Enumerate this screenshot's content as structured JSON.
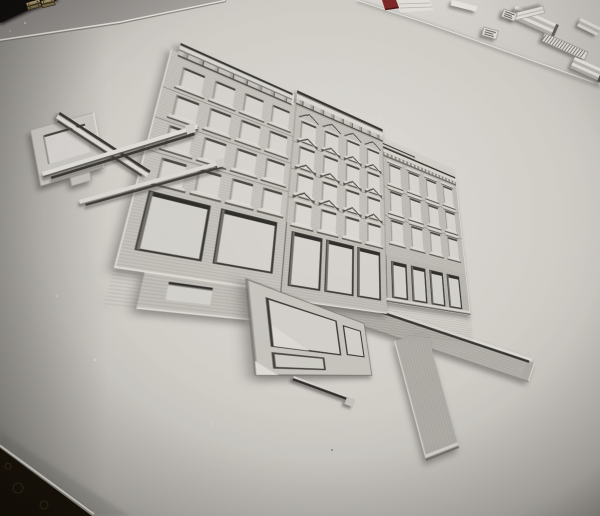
{
  "scene": {
    "description": "Overhead photograph of a hand-built architectural paper model: three row-building facades with cut-out windows, cornices and storefronts, lying flat on a large sheet of textured white watercolor paper",
    "surface": "white textured watercolor paper",
    "surroundings": {
      "top_left": "dark tabletop corner with two small brass hinge clasps",
      "top_right": "second paper sheet holding small spare model parts",
      "top_edge": "small dark-red object and white paper wedge",
      "bottom_left": "dark patterned fabric visible past the paper edge"
    }
  },
  "palette": {
    "paper_light": "#e0ddd8",
    "paper_mid": "#d2cfc9",
    "paper_dark": "#a19e99",
    "table_gray": "#9b9894",
    "second_sheet": "#d9d6d1",
    "wall_a": "#c9c6c0",
    "wall_b": "#c6c3bd",
    "wall_c": "#c2bfb9",
    "storefront_a": "#c6c3bd",
    "storefront_b": "#c2bfb9",
    "storefront_c": "#bebbb5",
    "opening": "#d8d5d0",
    "shadow_line": "#47443f",
    "deep_shadow": "#2c2a27",
    "highlight": "#eae7e1",
    "band_gray": "#b7b4ae",
    "dark_corner": "#131110",
    "fabric_dark": "#171108",
    "brass": "#b5a275",
    "red_object": "#7c2423"
  },
  "model": {
    "buildings": [
      {
        "id": "left-facade",
        "window_cols": 4,
        "window_rows": 4,
        "window_style": "plain-sill",
        "cornice": "bracketed-parapet"
      },
      {
        "id": "middle-facade",
        "window_cols": 4,
        "window_rows": 4,
        "window_style": "pediment",
        "cornice": "bracketed-tall"
      },
      {
        "id": "right-facade",
        "window_cols": 4,
        "window_rows": 3,
        "window_style": "lintel-ledge",
        "cornice": "dentil"
      }
    ],
    "street_level": [
      {
        "id": "storefront-left",
        "openings": 2
      },
      {
        "id": "storefront-middle",
        "openings": 3
      },
      {
        "id": "storefront-right",
        "openings": 4
      }
    ],
    "loose_parts": [
      {
        "id": "corner-storefront-frame"
      },
      {
        "id": "cornice-strip-bundles",
        "strips": 3
      },
      {
        "id": "lower-storefront-frame"
      },
      {
        "id": "l-shaped-baseboard"
      },
      {
        "id": "thin-molding-strip"
      }
    ],
    "spare_parts_tray": [
      "ridged cornice molding",
      "short ridged molding",
      "cross mullion piece",
      "cross-hatched ladder strip",
      "two tiny printed labels"
    ]
  }
}
